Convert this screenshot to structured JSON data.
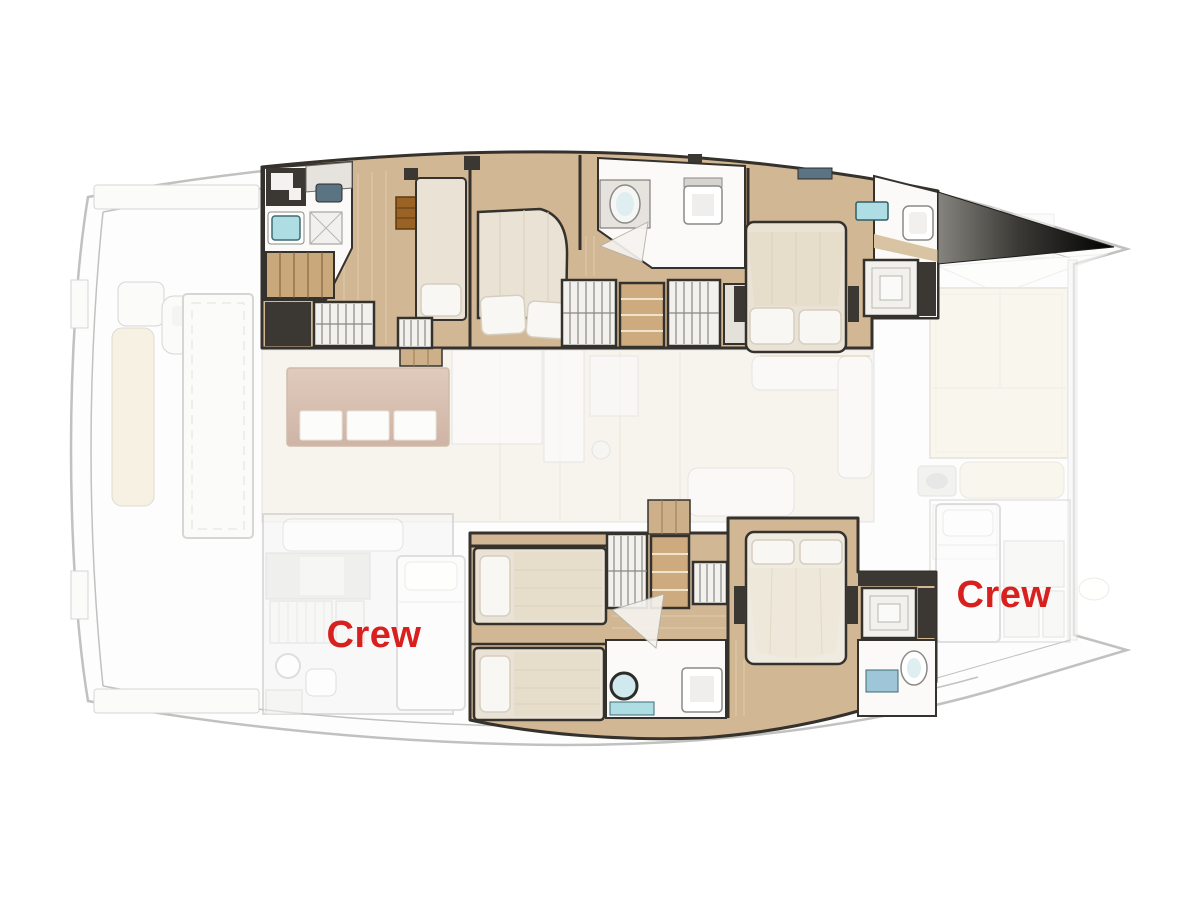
{
  "floor_plan": {
    "labels": {
      "crew_aft": {
        "text": "Crew",
        "color": "#d8201e"
      },
      "crew_forward": {
        "text": "Crew",
        "color": "#d8201e"
      }
    },
    "palette": {
      "wood_floor": "#d2b794",
      "wall_dark": "#35322d",
      "bed_cream": "#eae3d5",
      "pillow_white": "#f8f7f3",
      "locker_tan": "#cdab7e",
      "sink_teal": "#aedde4",
      "pad_beige": "#f1e6cf",
      "island_brown": "#b98a6a",
      "deck_line_gray": "#a2a2a0"
    }
  }
}
